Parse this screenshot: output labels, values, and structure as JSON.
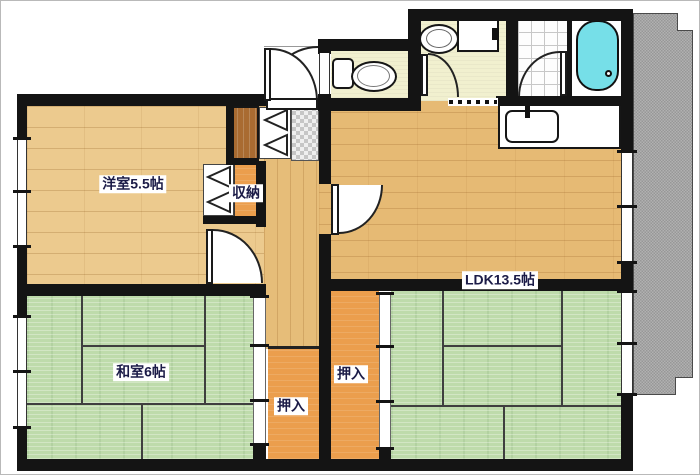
{
  "labels": {
    "western_room": "洋室5.5帖",
    "storage": "収納",
    "ldk": "LDK13.5帖",
    "japanese_room": "和室6帖",
    "closet_left": "押入",
    "closet_right": "押入"
  },
  "colors": {
    "wall_black": "#141414",
    "wood_western": "#ecca8e",
    "wood_ldk": "#e6ba74",
    "wood_hall": "#e6bd79",
    "tatami_green": "#bedbab",
    "tatami_line": "#3f3f3f",
    "closet_orange": "#eb9e4d",
    "cabinet_brown": "#a96b31",
    "sanitary_floor": "#f1f0cf",
    "bathtub_cyan": "#76dfe8",
    "balcony_gray": "#a2a2a2",
    "label_text": "#1b1b47"
  }
}
